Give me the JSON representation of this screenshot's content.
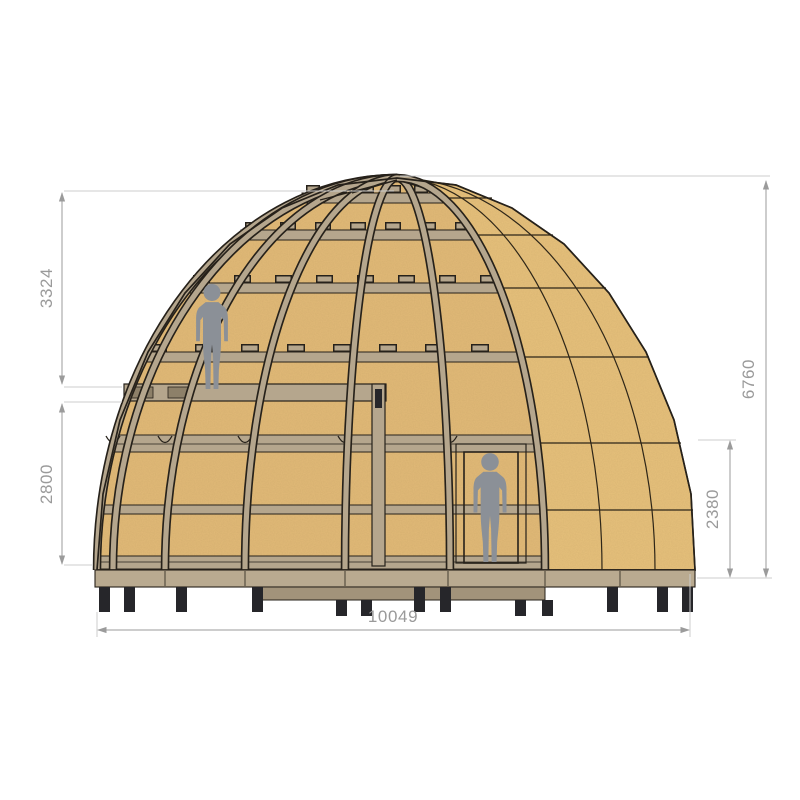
{
  "drawing": {
    "type": "architectural-elevation",
    "subject": "wooden geodesic dome house cutaway section with scale figures",
    "dimensions": {
      "upper_height": "3324",
      "lower_height": "2800",
      "total_height": "6760",
      "right_wall_height": "2380",
      "base_width": "10049"
    },
    "colors": {
      "background": "#ffffff",
      "osb": "#e7c17c",
      "osb_interior": "#e2ba78",
      "osb_seam": "#2e2618",
      "frame": "#b5a68d",
      "frame_dark": "#8d8069",
      "outline": "#26211a",
      "person": "#8b9097",
      "foundation": "#b9aa90",
      "foundation_step": "#a2937a",
      "foot": "#26262a",
      "dim_line": "#9b9b9b",
      "dim_ext": "#cccccc",
      "dim_text": "#9a9a9a"
    }
  }
}
